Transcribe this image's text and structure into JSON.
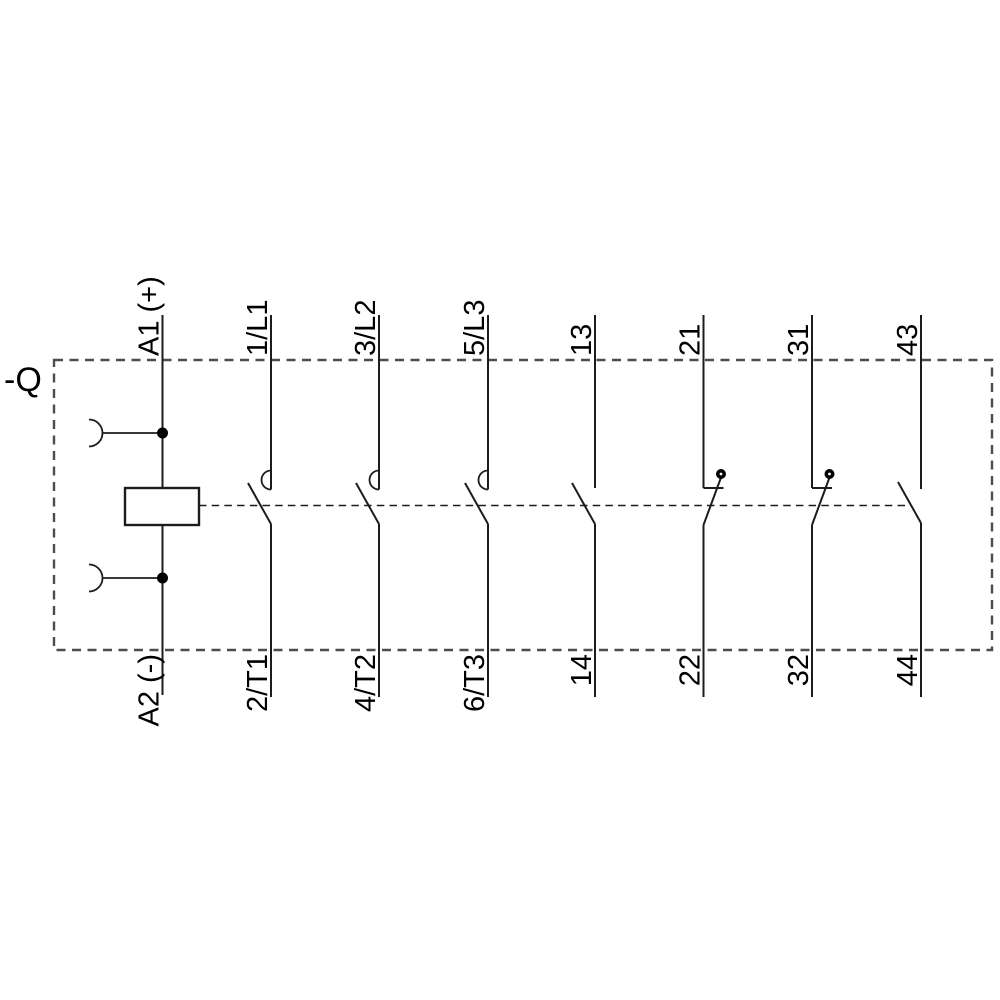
{
  "diagram": {
    "type": "contactor-schematic",
    "device_label": "-Q",
    "coil": {
      "top_terminal": "A1 (+)",
      "bottom_terminal": "A2 (-)"
    },
    "poles": [
      {
        "top": "1/L1",
        "bottom": "2/T1",
        "kind": "main-contact-no"
      },
      {
        "top": "3/L2",
        "bottom": "4/T2",
        "kind": "main-contact-no"
      },
      {
        "top": "5/L3",
        "bottom": "6/T3",
        "kind": "main-contact-no"
      },
      {
        "top": "13",
        "bottom": "14",
        "kind": "aux-contact-no"
      },
      {
        "top": "21",
        "bottom": "22",
        "kind": "aux-contact-nc"
      },
      {
        "top": "31",
        "bottom": "32",
        "kind": "aux-contact-nc"
      },
      {
        "top": "43",
        "bottom": "44",
        "kind": "aux-contact-no"
      }
    ],
    "colors": {
      "line": "#1c1c1c",
      "enclosure_border": "#4d4d4d",
      "background": "#ffffff"
    }
  }
}
